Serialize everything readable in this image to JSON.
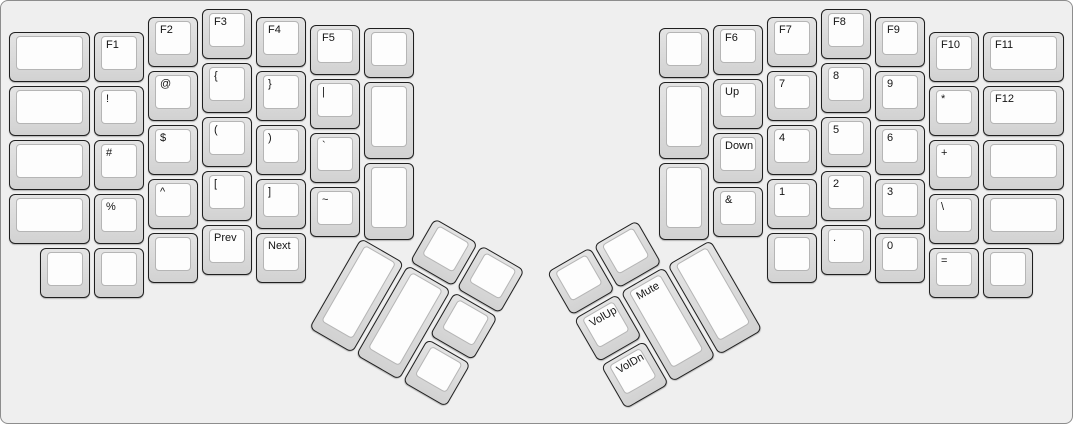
{
  "colors": {
    "background": "#efefef",
    "keycap_rim": "#d8d8d8",
    "keycap_face": "#fdfdfd",
    "keycap_border": "#1f1f1f",
    "label_text": "#141414"
  },
  "keys": {
    "left": {
      "outer_col": [
        "",
        "",
        "",
        ""
      ],
      "col_f1": [
        "F1",
        "!",
        "#",
        "%"
      ],
      "col_f2": [
        "F2",
        "@",
        "$",
        "^"
      ],
      "col_f3": [
        "F3",
        "{",
        "(",
        "["
      ],
      "col_f4": [
        "F4",
        "}",
        ")",
        "]"
      ],
      "col_f5": [
        "F5",
        "|",
        "`",
        "~"
      ],
      "inner_col": [
        "",
        "",
        ""
      ],
      "bottom_row": [
        "",
        "",
        "",
        "Prev",
        "Next"
      ],
      "thumb": {
        "top": [
          "",
          ""
        ],
        "tall": [
          "",
          ""
        ],
        "side": [
          "",
          ""
        ]
      }
    },
    "right": {
      "inner_col": [
        "",
        "",
        ""
      ],
      "col_f6": [
        "F6",
        "Up",
        "Down",
        "&"
      ],
      "col_f7": [
        "F7",
        "7",
        "4",
        "1"
      ],
      "col_f8": [
        "F8",
        "8",
        "5",
        "2"
      ],
      "col_f9": [
        "F9",
        "9",
        "6",
        "3"
      ],
      "col_f10": [
        "F10",
        "*",
        "+",
        "\\"
      ],
      "outer_col": [
        "F11",
        "F12",
        "",
        ""
      ],
      "bottom_row": [
        "",
        ".",
        "0",
        "=",
        ""
      ],
      "thumb": {
        "top": [
          "",
          ""
        ],
        "tall": [
          "Mute",
          ""
        ],
        "side": [
          "VolUp",
          "VolDn"
        ]
      }
    }
  }
}
